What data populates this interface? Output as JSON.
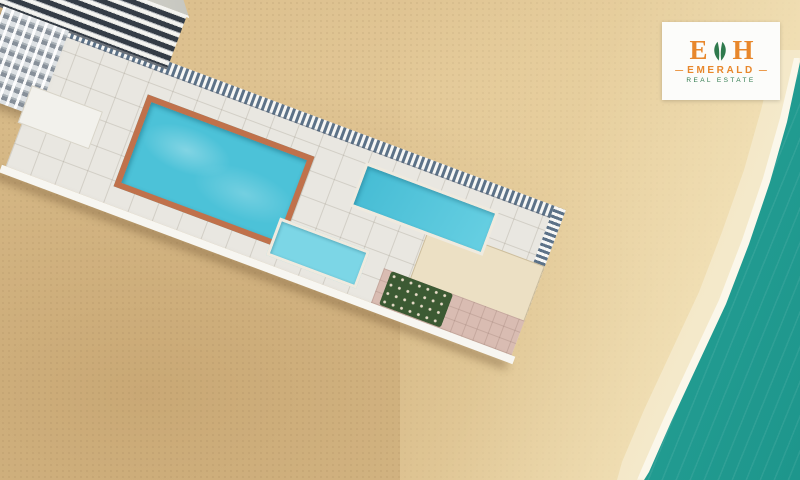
{
  "logo": {
    "letter_left": "E",
    "letter_right": "H",
    "brand": "EMERALD",
    "tagline": "REAL ESTATE",
    "dash_left": "—",
    "dash_right": "—"
  },
  "colors": {
    "sand": "#d9bc8a",
    "sand_dark": "#c9a875",
    "wet_sand": "#f3e7c6",
    "foam": "#fbf7ea",
    "ocean_shallow": "#5cc6b8",
    "ocean": "#2aa89c",
    "ocean_deep": "#1e968c",
    "deck": "#e9e7e1",
    "stripe_blue": "#5c7288",
    "stripe_white": "#f7f7f5",
    "pool_water": "#4cc2d8",
    "pool_border": "#c0714b",
    "kids_water": "#7cd6e6",
    "greenery": "#3c5a33",
    "umbrella_blue": "#3d7fc0",
    "umbrella_orange": "#e9a83c",
    "umbrella_white": "#f3efe6",
    "umbrella_yellow": "#e8c33c",
    "umbrella_teal": "#3fae9e",
    "straw": "#e0c48e",
    "lounger_stripe": "#4a5a68",
    "cabana": "#f7f5f0",
    "kayak": "#e7c64a",
    "lifebuoy": "#d84b4b",
    "window": "#343c46",
    "slide_red": "#d84b4b",
    "slide_blue": "#3f7fc0",
    "slide_green": "#4a9e5c",
    "slide_pink": "#e87fb0",
    "logo_orange": "#e8872b",
    "logo_green": "#2f7a4d",
    "logo_bg": "#fcfcfa"
  }
}
